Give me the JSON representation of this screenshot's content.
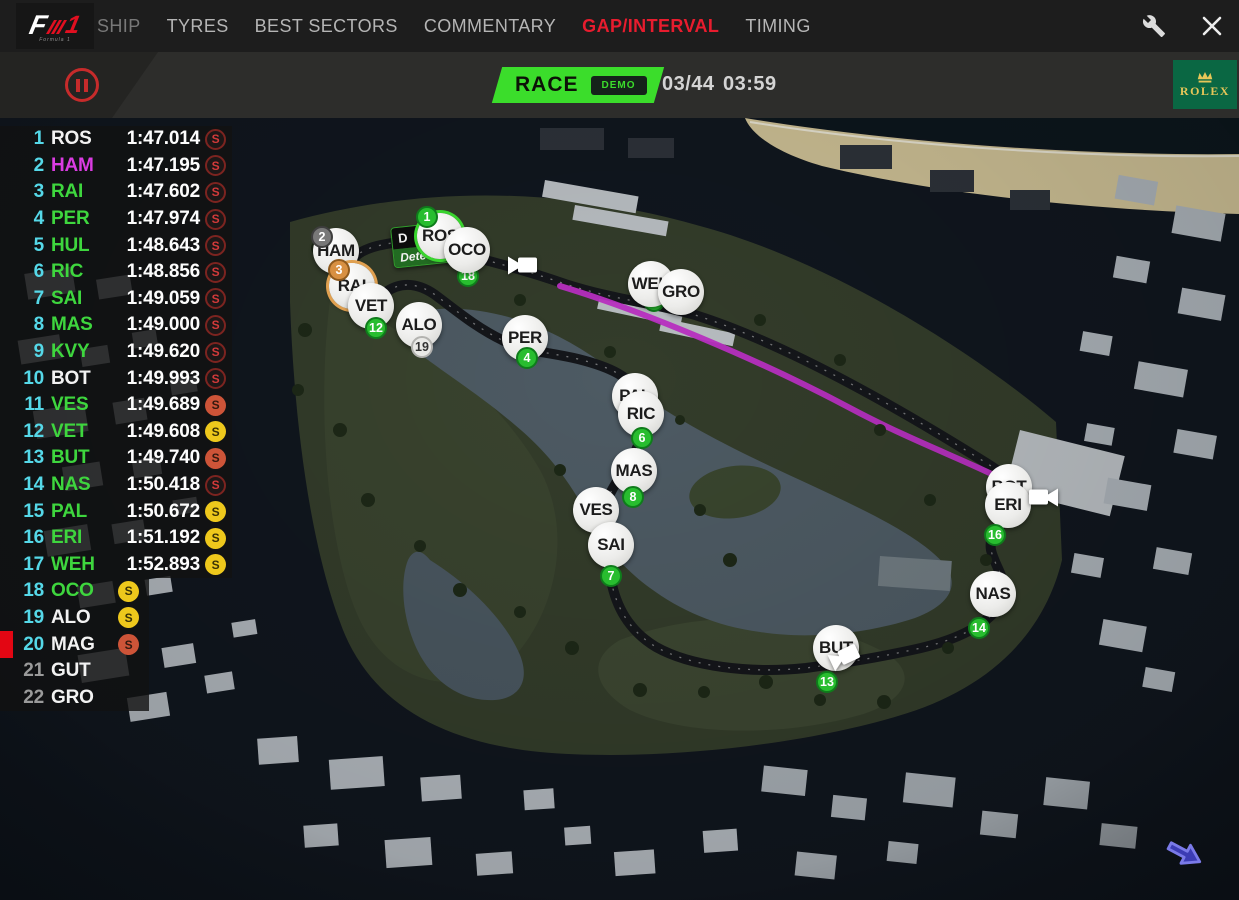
{
  "nav": {
    "logo": {
      "f": "F",
      "one": "1",
      "subtitle": "Formula 1"
    },
    "tabs": [
      {
        "label": "SHIP",
        "active": false,
        "partial": true
      },
      {
        "label": "TYRES",
        "active": false
      },
      {
        "label": "BEST SECTORS",
        "active": false
      },
      {
        "label": "COMMENTARY",
        "active": false
      },
      {
        "label": "GAP/INTERVAL",
        "active": true
      },
      {
        "label": "TIMING",
        "active": false
      }
    ],
    "active_color": "#e81c2e",
    "icons": [
      "wrench-icon",
      "close-icon"
    ]
  },
  "race_bar": {
    "session_label": "RACE",
    "session_badge": "DEMO",
    "lap_counter": "03/44",
    "session_time": "03:59",
    "sponsor": "ROLEX",
    "accent_green": "#3bdd2b",
    "pause_color": "#c62b2b",
    "rolex_green": "#0a6743",
    "rolex_gold": "#e6c658"
  },
  "leaderboard": {
    "colors": {
      "position_cyan": "#55d8e8",
      "name_green": "#3ed63e",
      "name_magenta": "#da3ce2",
      "name_white": "#f2f2f2",
      "dim_gray": "#9a9a9a",
      "flag_red": "#e30613"
    },
    "rows": [
      {
        "pos": "1",
        "code": "ROS",
        "color": "white",
        "time": "1:47.014",
        "tyre": "worn"
      },
      {
        "pos": "2",
        "code": "HAM",
        "color": "magenta",
        "time": "1:47.195",
        "tyre": "worn"
      },
      {
        "pos": "3",
        "code": "RAI",
        "color": "green",
        "time": "1:47.602",
        "tyre": "worn"
      },
      {
        "pos": "4",
        "code": "PER",
        "color": "green",
        "time": "1:47.974",
        "tyre": "worn"
      },
      {
        "pos": "5",
        "code": "HUL",
        "color": "green",
        "time": "1:48.643",
        "tyre": "worn"
      },
      {
        "pos": "6",
        "code": "RIC",
        "color": "green",
        "time": "1:48.856",
        "tyre": "worn"
      },
      {
        "pos": "7",
        "code": "SAI",
        "color": "green",
        "time": "1:49.059",
        "tyre": "worn"
      },
      {
        "pos": "8",
        "code": "MAS",
        "color": "green",
        "time": "1:49.000",
        "tyre": "worn"
      },
      {
        "pos": "9",
        "code": "KVY",
        "color": "green",
        "time": "1:49.620",
        "tyre": "worn"
      },
      {
        "pos": "10",
        "code": "BOT",
        "color": "white",
        "time": "1:49.993",
        "tyre": "worn"
      },
      {
        "pos": "11",
        "code": "VES",
        "color": "green",
        "time": "1:49.689",
        "tyre": "red"
      },
      {
        "pos": "12",
        "code": "VET",
        "color": "green",
        "time": "1:49.608",
        "tyre": "yellow"
      },
      {
        "pos": "13",
        "code": "BUT",
        "color": "green",
        "time": "1:49.740",
        "tyre": "red"
      },
      {
        "pos": "14",
        "code": "NAS",
        "color": "green",
        "time": "1:50.418",
        "tyre": "worn"
      },
      {
        "pos": "15",
        "code": "PAL",
        "color": "green",
        "time": "1:50.672",
        "tyre": "yellow"
      },
      {
        "pos": "16",
        "code": "ERI",
        "color": "green",
        "time": "1:51.192",
        "tyre": "yellow"
      },
      {
        "pos": "17",
        "code": "WEH",
        "color": "green",
        "time": "1:52.893",
        "tyre": "yellow"
      },
      {
        "pos": "18",
        "code": "OCO",
        "color": "green",
        "time": "",
        "tyre": "yellow",
        "short": true
      },
      {
        "pos": "19",
        "code": "ALO",
        "color": "white",
        "time": "",
        "tyre": "yellow",
        "short": true
      },
      {
        "pos": "20",
        "code": "MAG",
        "color": "white",
        "time": "",
        "tyre": "red",
        "short": true,
        "flag": true
      },
      {
        "pos": "21",
        "code": "GUT",
        "color": "white",
        "time": "",
        "tyre": "none",
        "short": true,
        "pos_dim": true
      },
      {
        "pos": "22",
        "code": "GRO",
        "color": "white",
        "time": "",
        "tyre": "none",
        "short": true,
        "pos_dim": true
      }
    ]
  },
  "map": {
    "drs_sign": {
      "line1": "D",
      "line2": "Detect"
    },
    "magenta_sector": "#b92fc2",
    "markers": [
      {
        "code": "HAM",
        "x": 336,
        "y": 251,
        "badge": {
          "text": "2",
          "type": "gray",
          "dx": -14,
          "dy": -14
        }
      },
      {
        "code": "RAI",
        "x": 352,
        "y": 286,
        "ring": "#e0a050",
        "badge": {
          "text": "3",
          "type": "orange",
          "dx": -13,
          "dy": -16
        }
      },
      {
        "code": "VET",
        "x": 371,
        "y": 306,
        "badge": {
          "text": "12",
          "type": "green",
          "dx": 5,
          "dy": 22
        }
      },
      {
        "code": "ALO",
        "x": 419,
        "y": 325,
        "badge": {
          "text": "19",
          "type": "light",
          "dx": 3,
          "dy": 22
        }
      },
      {
        "code": "ROS",
        "x": 440,
        "y": 236,
        "ring": "#39d42e",
        "badge": {
          "text": "1",
          "type": "green",
          "dx": -13,
          "dy": -19
        }
      },
      {
        "code": "OCO",
        "x": 467,
        "y": 250,
        "badge": {
          "text": "18",
          "type": "green",
          "dx": 1,
          "dy": 26,
          "behind": true
        }
      },
      {
        "code": "PER",
        "x": 525,
        "y": 338,
        "badge": {
          "text": "4",
          "type": "green",
          "dx": 2,
          "dy": 20
        }
      },
      {
        "code": "WEH",
        "x": 651,
        "y": 284,
        "badge": {
          "text": "17",
          "type": "green",
          "dx": 3,
          "dy": 17,
          "behind": true
        }
      },
      {
        "code": "GRO",
        "x": 681,
        "y": 292
      },
      {
        "code": "PAL",
        "x": 635,
        "y": 396
      },
      {
        "code": "RIC",
        "x": 641,
        "y": 414,
        "badge": {
          "text": "6",
          "type": "green",
          "dx": 1,
          "dy": 24
        }
      },
      {
        "code": "MAS",
        "x": 634,
        "y": 471,
        "badge": {
          "text": "8",
          "type": "green",
          "dx": -1,
          "dy": 26
        }
      },
      {
        "code": "VES",
        "x": 596,
        "y": 510
      },
      {
        "code": "SAI",
        "x": 611,
        "y": 545,
        "badge": {
          "text": "7",
          "type": "green",
          "dx": 0,
          "dy": 31
        }
      },
      {
        "code": "BOT",
        "x": 1009,
        "y": 487
      },
      {
        "code": "ERI",
        "x": 1008,
        "y": 505,
        "badge": {
          "text": "16",
          "type": "green",
          "dx": -13,
          "dy": 30
        }
      },
      {
        "code": "NAS",
        "x": 993,
        "y": 594,
        "badge": {
          "text": "14",
          "type": "green",
          "dx": -14,
          "dy": 34
        }
      },
      {
        "code": "BUT",
        "x": 836,
        "y": 648,
        "badge": {
          "text": "13",
          "type": "green",
          "dx": -9,
          "dy": 34
        }
      }
    ],
    "cameras": [
      {
        "x": 523,
        "y": 268,
        "rot": 0
      },
      {
        "x": 1043,
        "y": 500,
        "rot": 0,
        "flip": true
      },
      {
        "x": 846,
        "y": 659,
        "rot": -25
      }
    ]
  }
}
